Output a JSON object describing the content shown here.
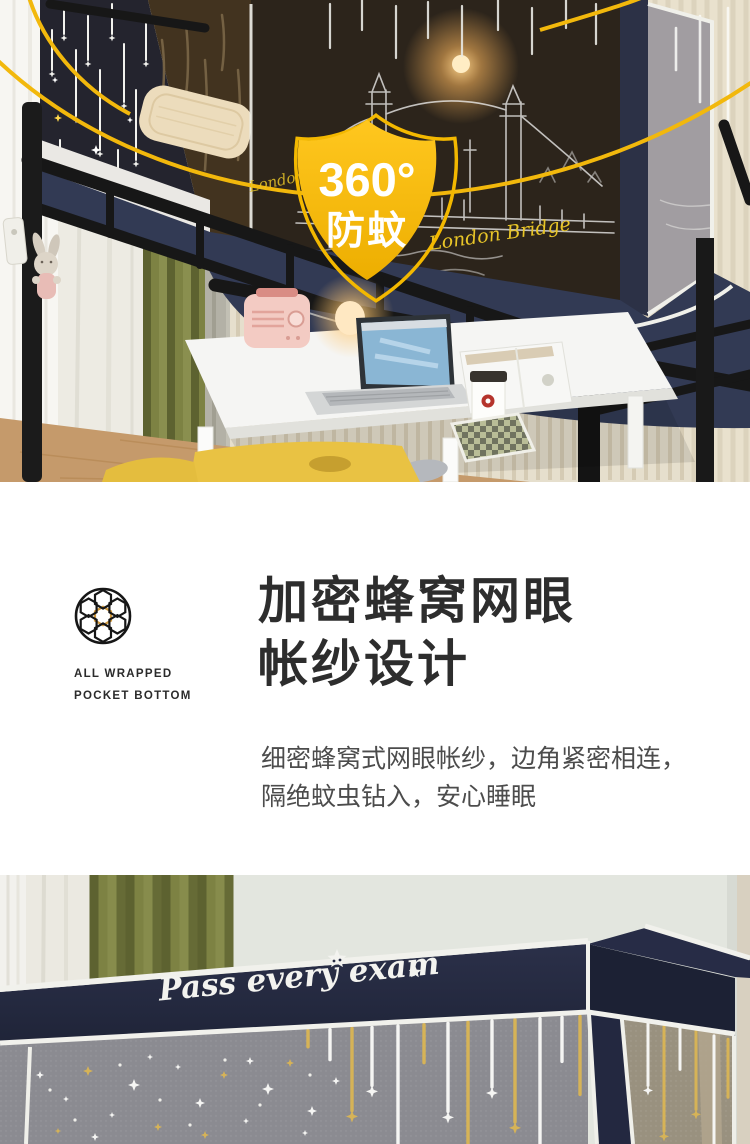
{
  "colors": {
    "accent_gold": "#f3b800",
    "valance_navy": "#252a42",
    "heading_text": "#2d2d2d",
    "body_text": "#4c4c4c"
  },
  "hero_photo": {
    "badge": {
      "top": "360°",
      "bottom": "防蚊"
    },
    "fabric_script": "London Bridge"
  },
  "feature_section": {
    "icon": "honeycomb-mesh-icon",
    "tagline_line1": "ALL WRAPPED",
    "tagline_line2": "POCKET BOTTOM",
    "title_line1": "加密蜂窝网眼",
    "title_line2": "帐纱设计",
    "desc_line1": "细密蜂窝式网眼帐纱，边角紧密相连，",
    "desc_line2": "隔绝蚊虫钻入，安心睡眠"
  },
  "bottom_photo": {
    "embroidery_text": "Pass every exam"
  }
}
